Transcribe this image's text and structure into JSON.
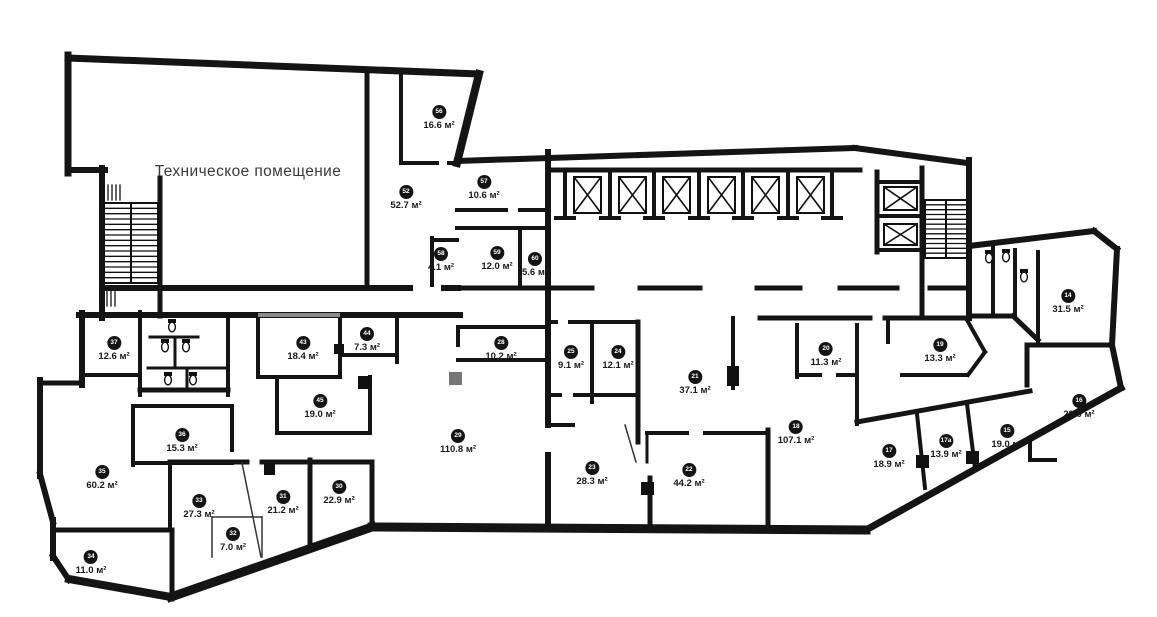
{
  "technical_room": {
    "label": "Техническое помещение"
  },
  "area_unit": "м²",
  "rooms": [
    {
      "number": "56",
      "area": "16.6 м²"
    },
    {
      "number": "52",
      "area": "52.7 м²"
    },
    {
      "number": "57",
      "area": "10.6 м²"
    },
    {
      "number": "58",
      "area": "4.1 м²"
    },
    {
      "number": "59",
      "area": "12.0 м²"
    },
    {
      "number": "60",
      "area": "5.6 м²"
    },
    {
      "number": "14",
      "area": "31.5 м²"
    },
    {
      "number": "37",
      "area": "12.6 м²"
    },
    {
      "number": "43",
      "area": "18.4 м²"
    },
    {
      "number": "44",
      "area": "7.3 м²"
    },
    {
      "number": "28",
      "area": "10.2 м²"
    },
    {
      "number": "25",
      "area": "9.1 м²"
    },
    {
      "number": "24",
      "area": "12.1 м²"
    },
    {
      "number": "21",
      "area": "37.1 м²"
    },
    {
      "number": "20",
      "area": "11.3 м²"
    },
    {
      "number": "19",
      "area": "13.3 м²"
    },
    {
      "number": "45",
      "area": "19.0 м²"
    },
    {
      "number": "29",
      "area": "110.8 м²"
    },
    {
      "number": "36",
      "area": "15.3 м²"
    },
    {
      "number": "16",
      "area": "29.0 м²"
    },
    {
      "number": "15",
      "area": "19.0 м²"
    },
    {
      "number": "17а",
      "area": "13.9 м²"
    },
    {
      "number": "17",
      "area": "18.9 м²"
    },
    {
      "number": "18",
      "area": "107.1 м²"
    },
    {
      "number": "35",
      "area": "60.2 м²"
    },
    {
      "number": "23",
      "area": "28.3 м²"
    },
    {
      "number": "22",
      "area": "44.2 м²"
    },
    {
      "number": "30",
      "area": "22.9 м²"
    },
    {
      "number": "33",
      "area": "27.3 м²"
    },
    {
      "number": "31",
      "area": "21.2 м²"
    },
    {
      "number": "32",
      "area": "7.0 м²"
    },
    {
      "number": "34",
      "area": "11.0 м²"
    }
  ]
}
